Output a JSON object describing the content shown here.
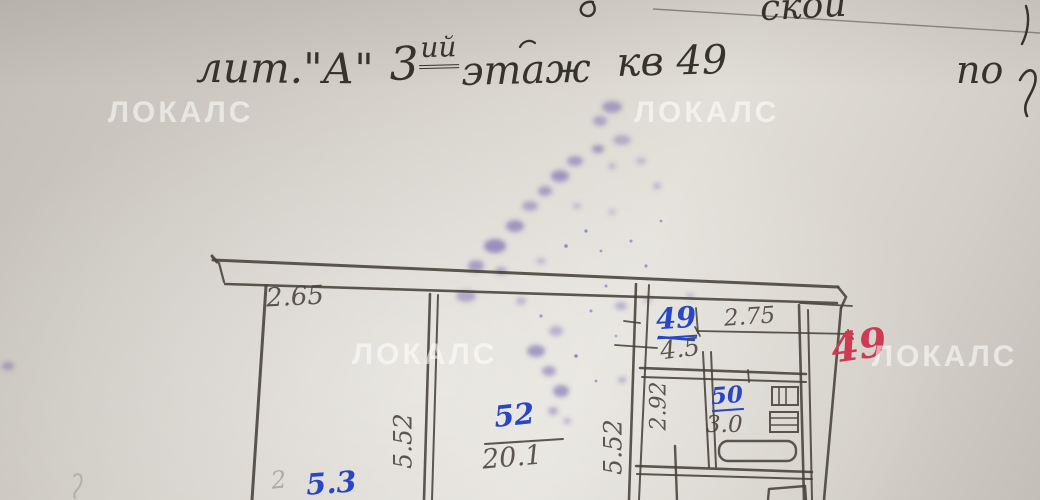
{
  "header": {
    "fragment_top_right": "скои",
    "title": {
      "lit": "лит.\"А\"",
      "floor_number": "3",
      "floor_suffix": "ий",
      "floor_word": "этаж",
      "apartment": "кв 49",
      "right_fragment": "по"
    }
  },
  "watermark": {
    "text": "ЛОКАЛС"
  },
  "plan": {
    "dims": {
      "d265": "2.65",
      "d275": "2.75",
      "d45": "4.5",
      "d30": "3.0",
      "d201": "20.1",
      "d552_left": "5.52",
      "d552_right": "5.52",
      "d292": "2.92",
      "faint_pencil": "2"
    },
    "room_numbers": {
      "blue49": "49",
      "blue50": "50",
      "blue52": "52",
      "blue53": "5.3"
    },
    "stamp_red": "49"
  },
  "colors": {
    "paper": "#d3cfc8",
    "paper-light": "#e2dfd8",
    "paper-dark": "#c3bfb8",
    "pencil": "#474139",
    "handwriting": "#36322c",
    "ink-blue": "#2946c5",
    "ink-red": "#cd3a52",
    "ink-smudge": "#5e4da6",
    "watermark": "#ffffff"
  }
}
